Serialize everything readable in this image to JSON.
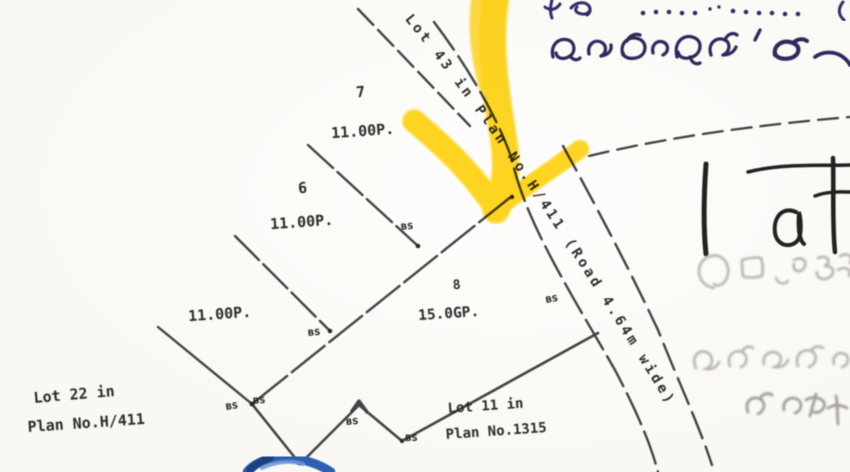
{
  "palette": {
    "paper": "#fbfaf6",
    "ink": "#3c3c3c",
    "label_ink": "#2e2c2c",
    "highlighter_yellow": "#ffd40d",
    "handwriting_indigo": "#332e66",
    "side_note_black": "#202020",
    "stamp_gray": "#b7b3aa",
    "blue_mark": "#2d5fb4"
  },
  "plan": {
    "road_label": "Lot 43 in Plan No.H/411  (Road 4.64m wide)",
    "road_fragment_note": "4/411 (Road 4.64m wide)",
    "plots": [
      {
        "number": "7",
        "area": "11.00P."
      },
      {
        "number": "6",
        "area": "11.00P."
      },
      {
        "number": "",
        "area": "11.00P."
      },
      {
        "number": "8",
        "area": "15.0GP."
      }
    ],
    "adjoining_lots": [
      {
        "line1": "Lot 22 in",
        "line2": "Plan No.H/411"
      },
      {
        "line1": "Lot 11 in",
        "line2": "Plan No.1315"
      }
    ],
    "marker_label": "BS"
  },
  "annotations": {
    "sinhala_top_line": "අංක ............. (",
    "sinhala_second_line": "කැබැල්ල  ' කැ…",
    "side_note": "| at…",
    "stamp_faint_line1": "faint stamped Sinhala text (illegible)",
    "stamp_faint_line2": "faint stamped Sinhala text (illegible)",
    "stamp_faint_line3": "faint stamped Sinhala text (illegible)",
    "highlight_arrow_meaning": "hand-drawn yellow arrow pointing at road junction",
    "blue_mark_meaning": "blue pen mark at bottom edge"
  }
}
